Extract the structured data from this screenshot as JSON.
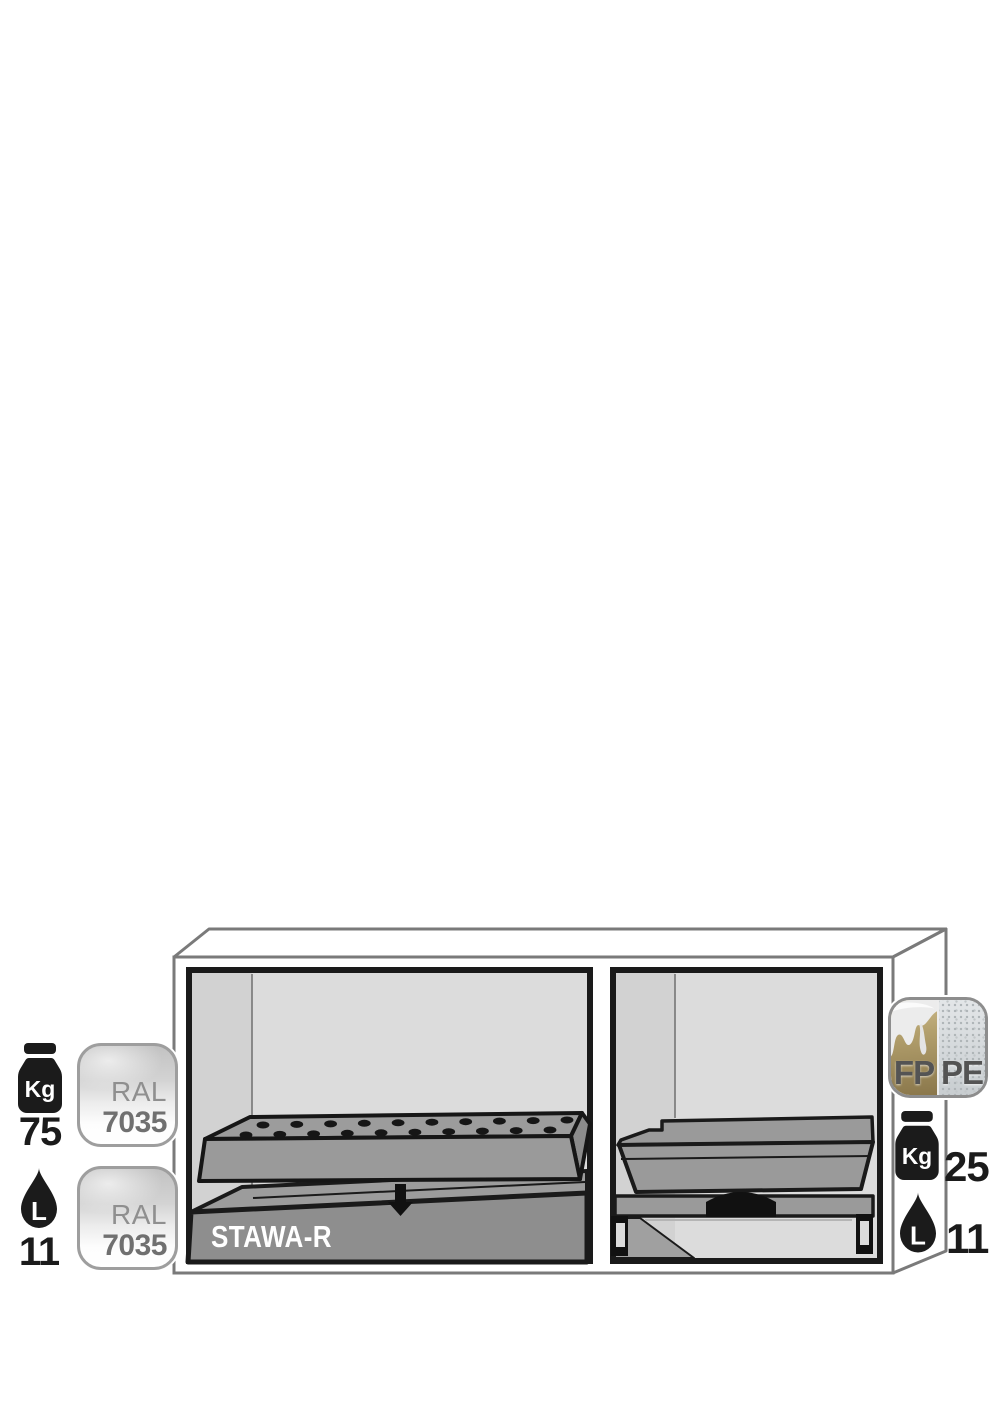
{
  "badges": {
    "left_weight": {
      "unit": "Kg",
      "value": "75"
    },
    "ral_top": {
      "prefix": "RAL",
      "code": "7035"
    },
    "left_volume": {
      "unit": "L",
      "value": "11"
    },
    "ral_bottom": {
      "prefix": "RAL",
      "code": "7035"
    },
    "material": {
      "fp": "FP",
      "pe": "PE"
    },
    "right_weight": {
      "unit": "Kg",
      "value": "25"
    },
    "right_volume": {
      "unit": "L",
      "value": "11"
    }
  },
  "cabinet": {
    "sump_label": "STAWA-R"
  },
  "colors": {
    "outline": "#1a1a1a",
    "cabinet_stroke": "#7a7a7a",
    "interior": "#dcdcdc",
    "interior_wall": "#d2d2d2",
    "tray_gray": "#9a9a9a",
    "sump_front": "#8e8e8e",
    "ral_text": "#8f8f8f",
    "fp_tan": "#b3a06d",
    "pe_gray": "#d6d9db"
  }
}
